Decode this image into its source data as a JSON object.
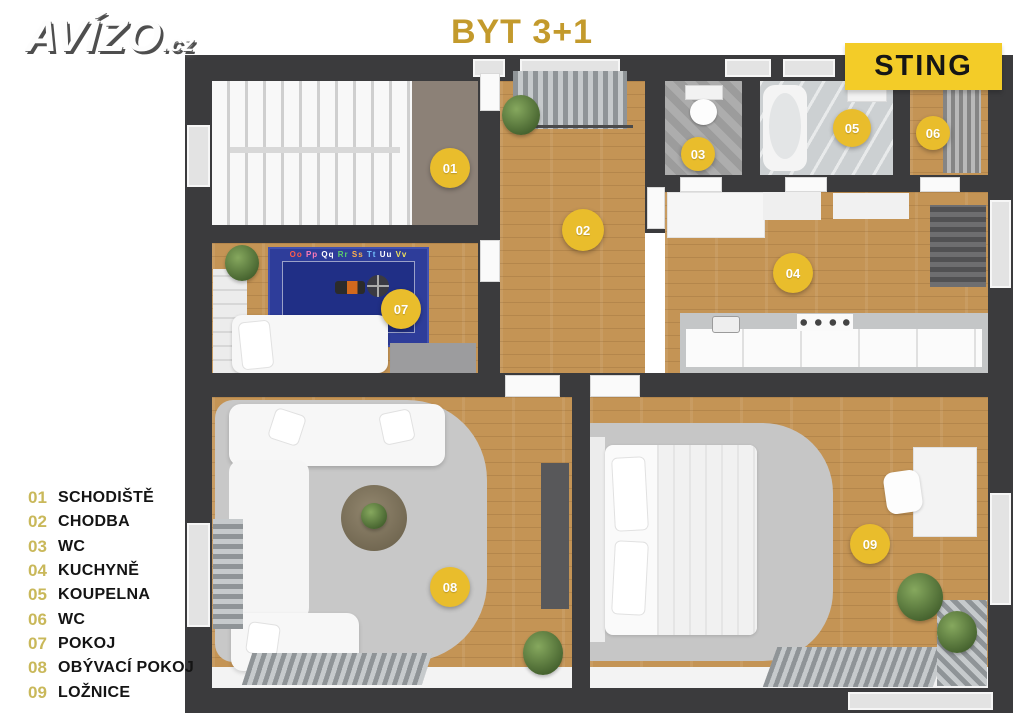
{
  "logo": {
    "text": "AVÍZO",
    "suffix": ".cz"
  },
  "header": {
    "title": "BYT 3+1",
    "title_color": "#c39a2c"
  },
  "badge": {
    "label": "STING",
    "bg": "#f3cc28",
    "text_color": "#161616"
  },
  "floorplan": {
    "marker_color": "#e9bd2c",
    "wall_color": "#3b3b3d",
    "wood_color": "#c49455",
    "rooms": [
      {
        "num": "01",
        "label": "SCHODIŠTĚ",
        "x": 265,
        "y": 113,
        "size": 40
      },
      {
        "num": "02",
        "label": "CHODBA",
        "x": 398,
        "y": 175,
        "size": 42
      },
      {
        "num": "03",
        "label": "WC",
        "x": 513,
        "y": 99,
        "size": 34
      },
      {
        "num": "04",
        "label": "KUCHYNĚ",
        "x": 608,
        "y": 218,
        "size": 40
      },
      {
        "num": "05",
        "label": "KOUPELNA",
        "x": 667,
        "y": 73,
        "size": 38
      },
      {
        "num": "06",
        "label": "WC",
        "x": 748,
        "y": 78,
        "size": 34
      },
      {
        "num": "07",
        "label": "POKOJ",
        "x": 216,
        "y": 254,
        "size": 40
      },
      {
        "num": "08",
        "label": "OBÝVACÍ POKOJ",
        "x": 265,
        "y": 532,
        "size": 40
      },
      {
        "num": "09",
        "label": "LOŽNICE",
        "x": 685,
        "y": 489,
        "size": 40
      }
    ],
    "rug_letters": [
      "Oo",
      "Pp",
      "Qq",
      "Rr",
      "Ss",
      "Tt",
      "Uu",
      "Vv"
    ],
    "rug_letter_colors": [
      "#ff5b4d",
      "#ff7ab8",
      "#ffffff",
      "#5ad06a",
      "#ffb04d",
      "#73c2ff",
      "#ffffff",
      "#efe05a"
    ]
  }
}
